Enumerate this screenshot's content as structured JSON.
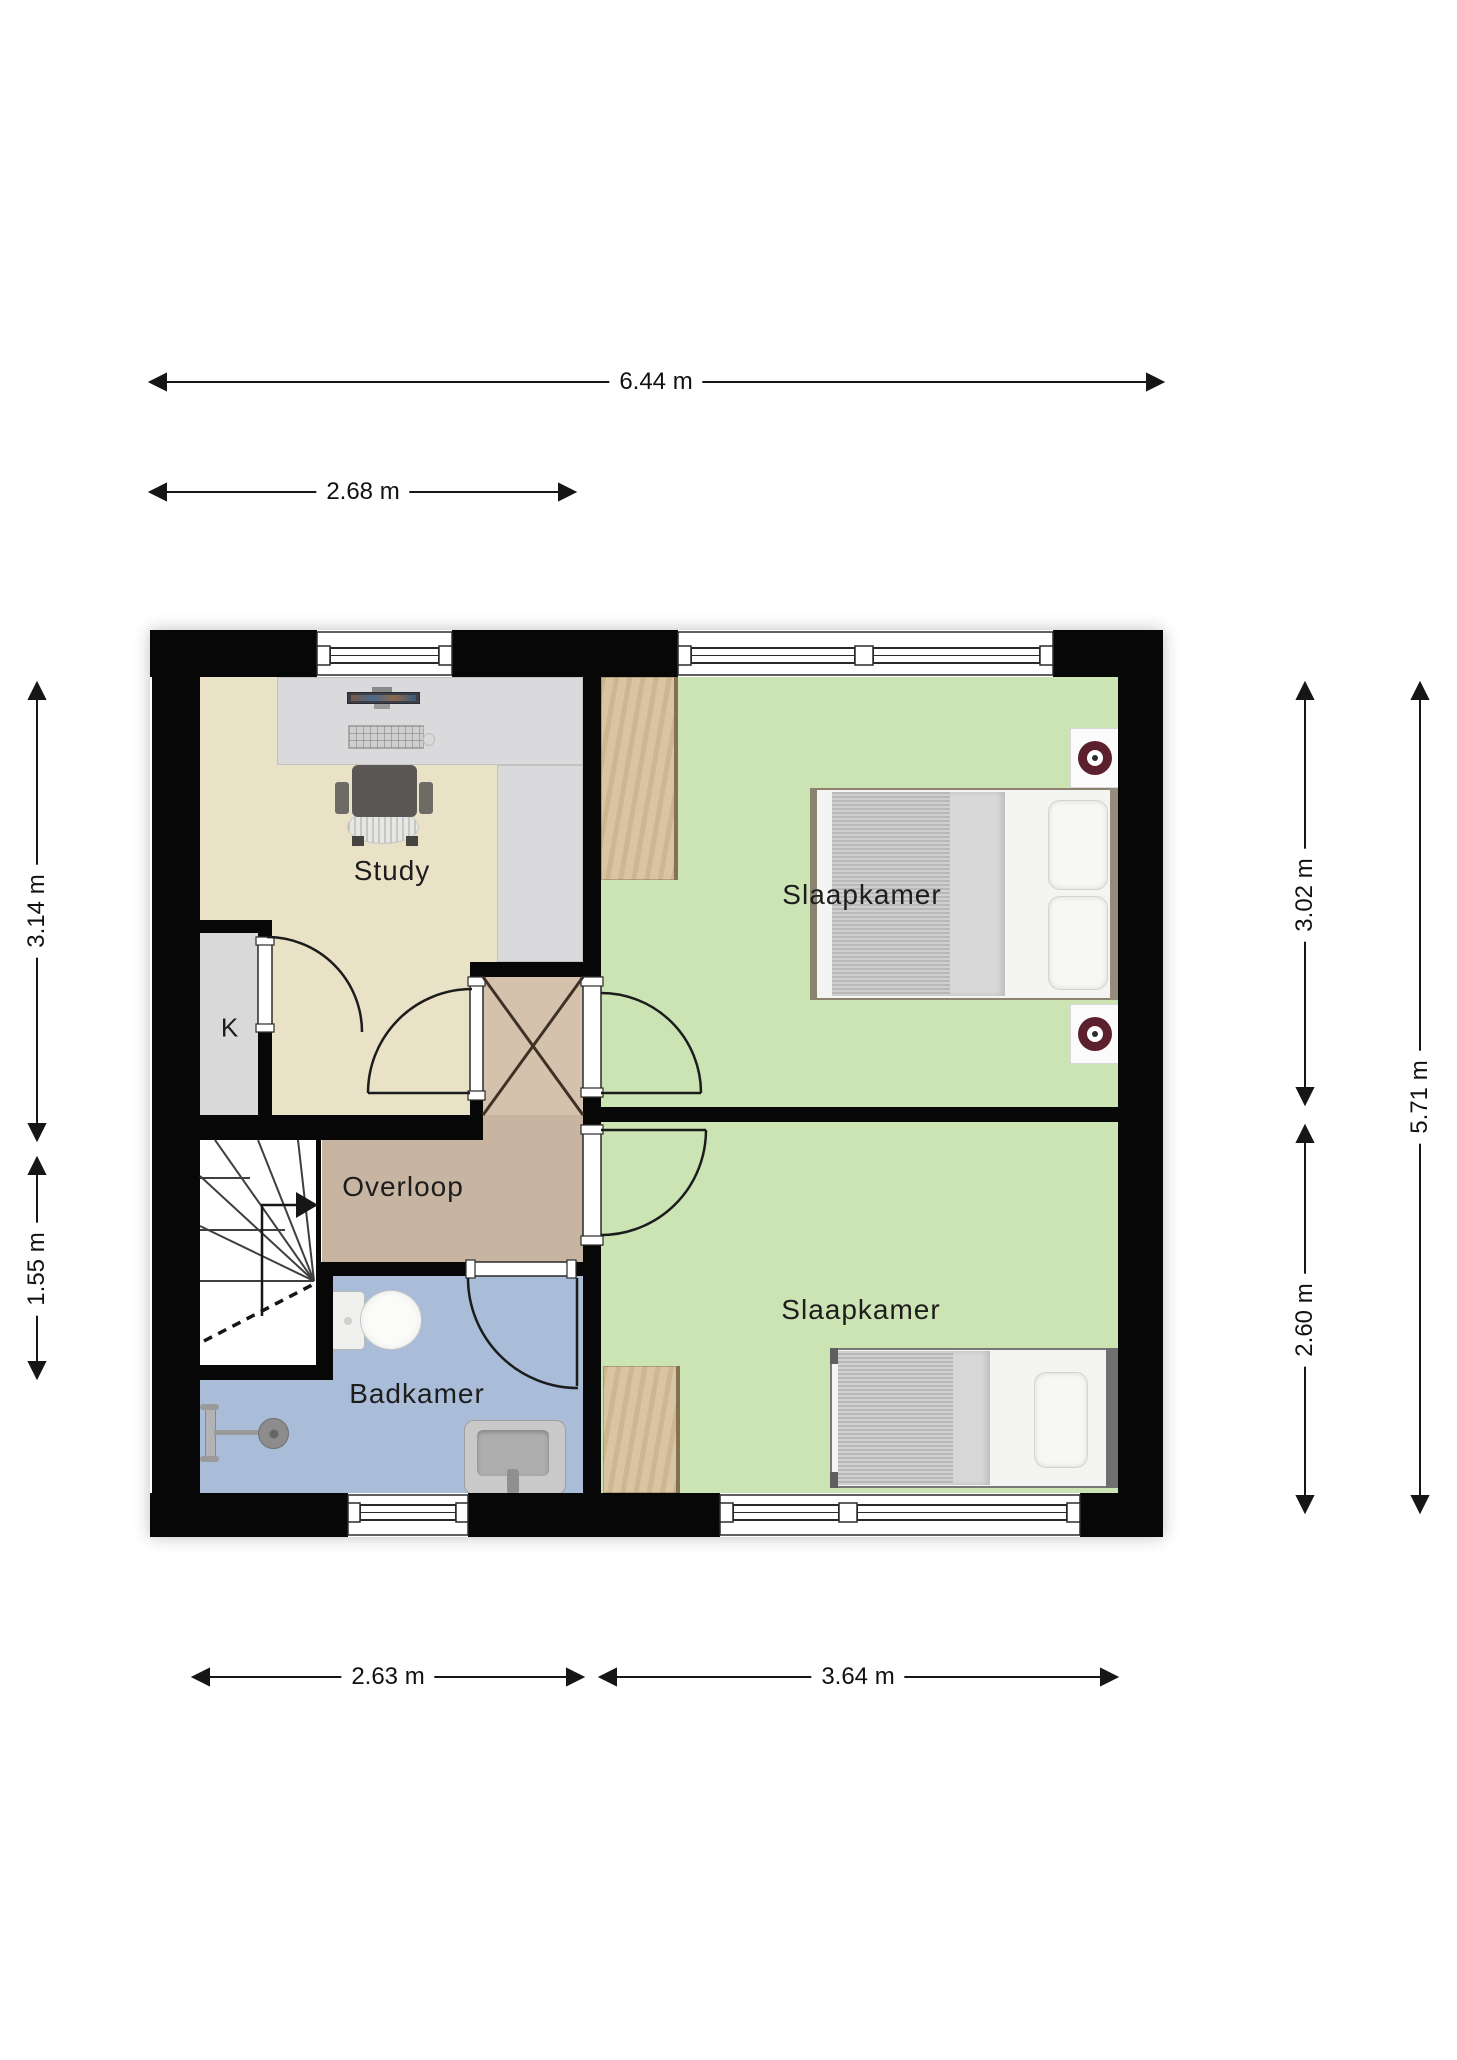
{
  "plan": {
    "type": "floorplan-first-floor",
    "language": "Dutch",
    "rooms": {
      "study": {
        "label": "Study"
      },
      "closet": {
        "label": "K"
      },
      "landing": {
        "label": "Overloop"
      },
      "bathroom": {
        "label": "Badkamer"
      },
      "bedroom_top": {
        "label": "Slaapkamer"
      },
      "bedroom_bottom": {
        "label": "Slaapkamer"
      }
    },
    "dimensions": {
      "width_total": "6.44 m",
      "width_left_rooms": "2.68 m",
      "height_study": "3.14 m",
      "height_stairs": "1.55 m",
      "height_bedroom_top": "3.02 m",
      "height_bedroom_bottom": "2.60 m",
      "height_total": "5.71 m",
      "width_bathroom": "2.63 m",
      "width_bedroom_bottom": "3.64 m"
    },
    "features": [
      "stairs-with-up-arrow",
      "void-cross-box",
      "double-bed",
      "single-bed",
      "two-wardrobes",
      "desk-with-monitor-keyboard",
      "office-chair",
      "toilet",
      "sink",
      "shower",
      "two-nightstands-with-lamps"
    ],
    "colors": {
      "wall": "#070707",
      "study_floor": "#eae2c7",
      "bedroom_floor": "#cce3b3",
      "bathroom_floor": "#a9bdd8",
      "landing_floor": "#c8b5a1",
      "void_box": "#d5c2ac",
      "closet_floor": "#d9d9d9",
      "wood": "#d9c5a2",
      "desk": "#dadadc",
      "lamp_accent": "#5c1f2e"
    }
  }
}
